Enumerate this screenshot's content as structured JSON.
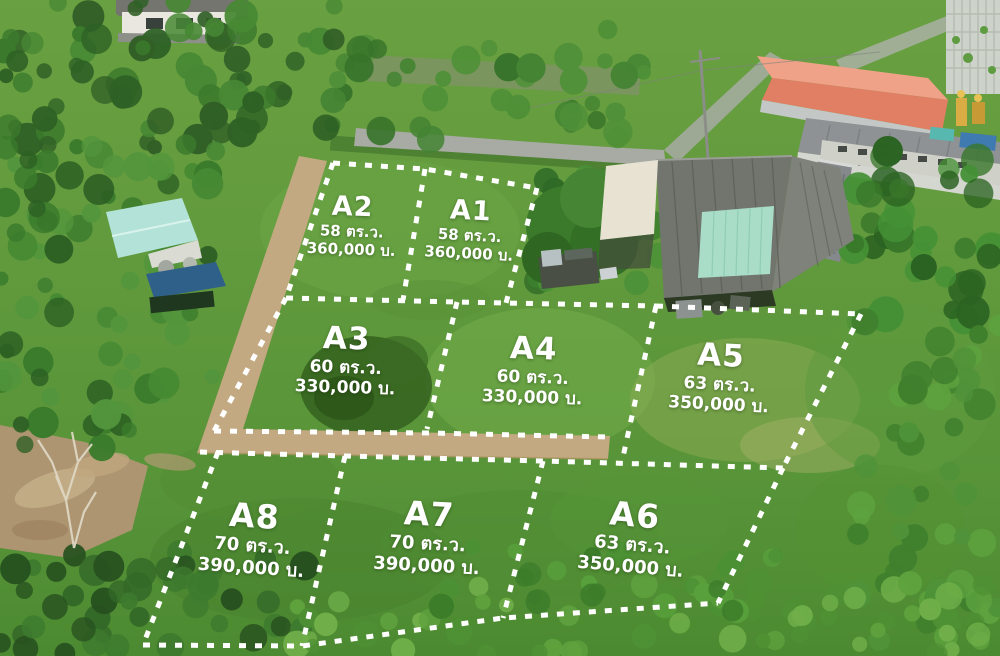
{
  "overlay": {
    "dash_color": "#ffffff",
    "road_color": "#c3a981",
    "label_color": "#ffffff"
  },
  "plots": [
    {
      "id": "A2",
      "area": "58 ตร.ว.",
      "price": "360,000 บ."
    },
    {
      "id": "A1",
      "area": "58 ตร.ว.",
      "price": "360,000 บ."
    },
    {
      "id": "A3",
      "area": "60 ตร.ว.",
      "price": "330,000 บ."
    },
    {
      "id": "A4",
      "area": "60 ตร.ว.",
      "price": "330,000 บ."
    },
    {
      "id": "A5",
      "area": "63 ตร.ว.",
      "price": "350,000 บ."
    },
    {
      "id": "A8",
      "area": "70 ตร.ว.",
      "price": "390,000 บ."
    },
    {
      "id": "A7",
      "area": "70 ตร.ว.",
      "price": "390,000 บ."
    },
    {
      "id": "A6",
      "area": "63 ตร.ว.",
      "price": "350,000 บ."
    }
  ]
}
